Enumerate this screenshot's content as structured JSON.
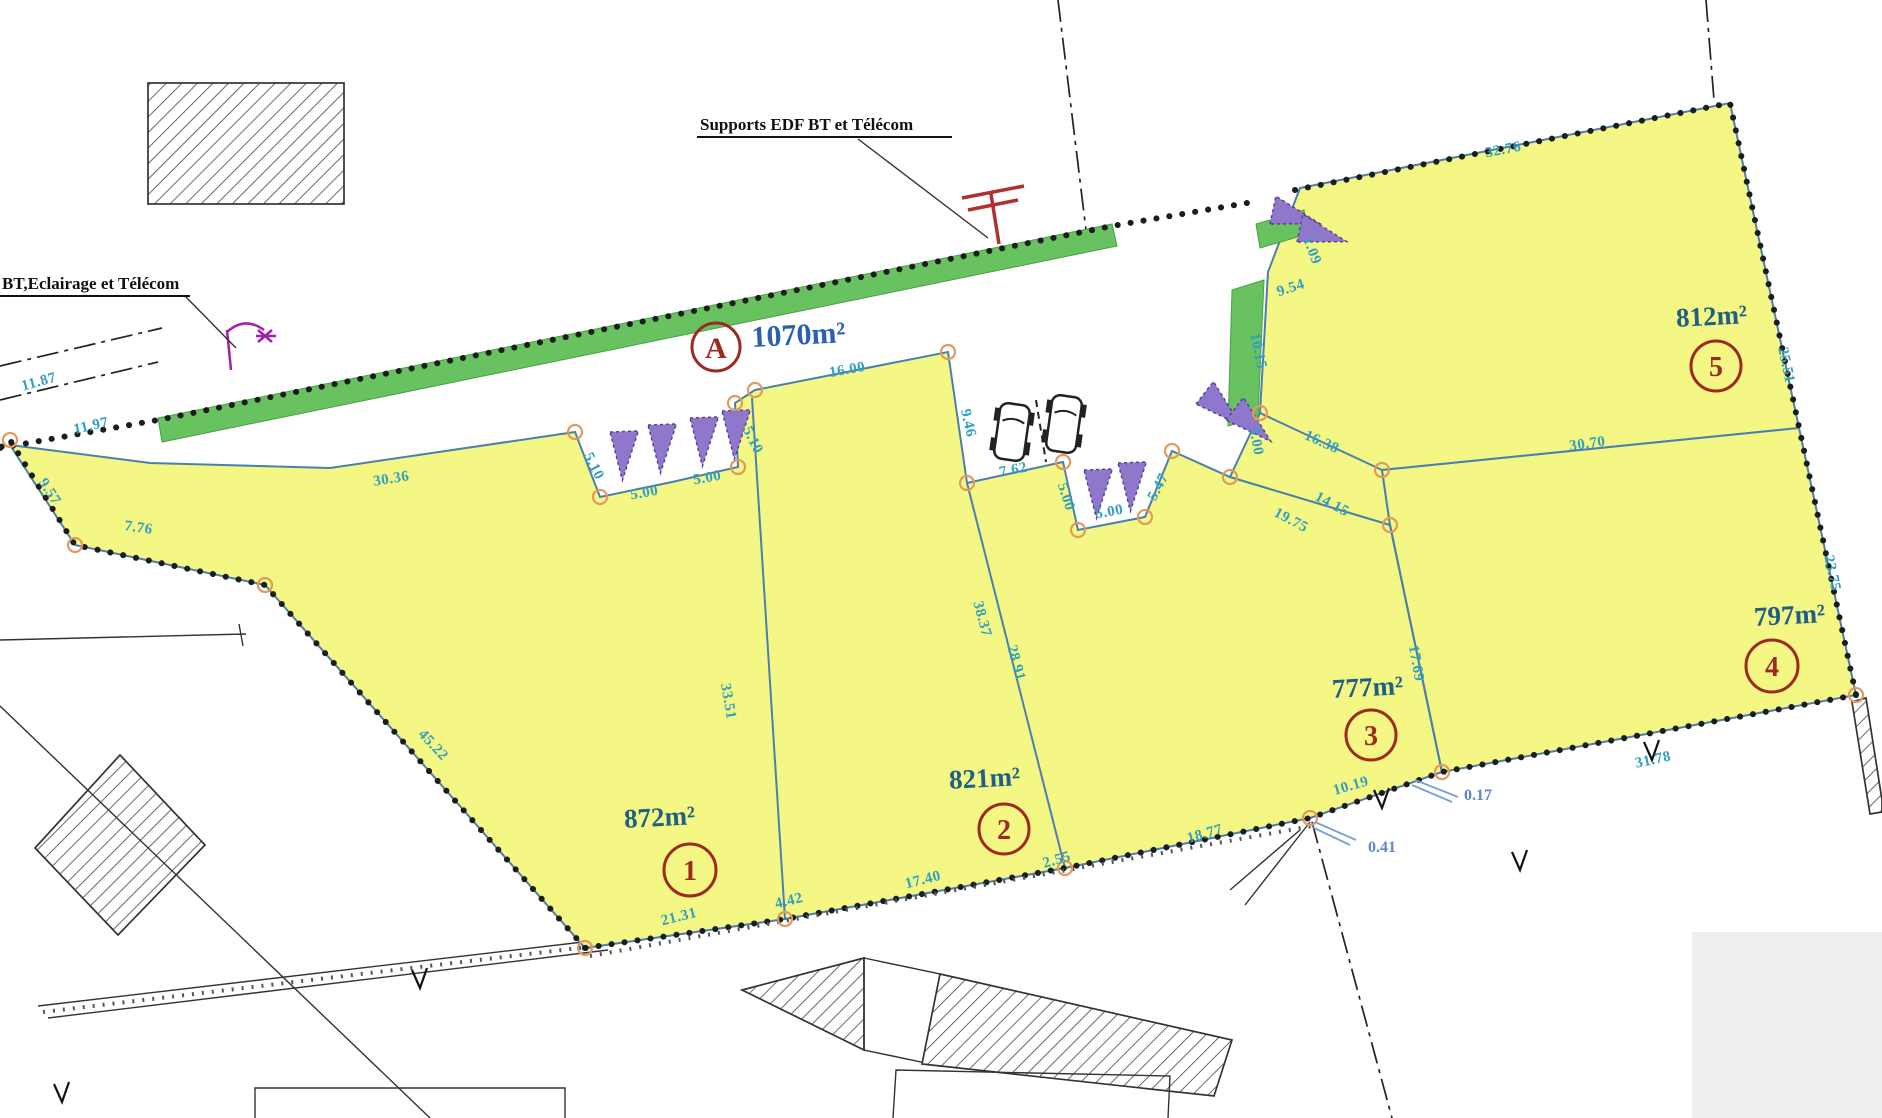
{
  "annotations": {
    "supports_label": "Supports EDF BT et  Télécom",
    "bt_label": "BT,Eclairage et Télécom"
  },
  "parcels": [
    {
      "id": "A",
      "area": "1070m²"
    },
    {
      "id": "1",
      "area": "872m²"
    },
    {
      "id": "2",
      "area": "821m²"
    },
    {
      "id": "3",
      "area": "777m²"
    },
    {
      "id": "4",
      "area": "797m²"
    },
    {
      "id": "5",
      "area": "812m²"
    }
  ],
  "dims": [
    "11.87",
    "11.97",
    "9.57",
    "7.76",
    "45.22",
    "30.36",
    "5.10",
    "5.00",
    "5.00",
    "5.10",
    "16.00",
    "9.46",
    "7.62",
    "5.00",
    "5.00",
    "5.47",
    "5.00",
    "16.38",
    "19.75",
    "14.15",
    "30.70",
    "10.15",
    "9.54",
    "1.09",
    "32.76",
    "25.51",
    "23.75",
    "31.78",
    "17.69",
    "38.37",
    "28.91",
    "33.51",
    "10.19",
    "0.17",
    "0.41",
    "18.77",
    "2.55",
    "17.40",
    "4.42",
    "21.31"
  ],
  "colors": {
    "parcel_fill": "#f5f784",
    "verge_green": "#67c25f",
    "triangle_purple": "#8f78cc",
    "boundary_blue": "#4a7fae",
    "circle_red": "#9c2a21",
    "dim_text": "#2e9fc0",
    "area_text": "#1d5f86",
    "road_area_text": "#2b5fb0"
  }
}
